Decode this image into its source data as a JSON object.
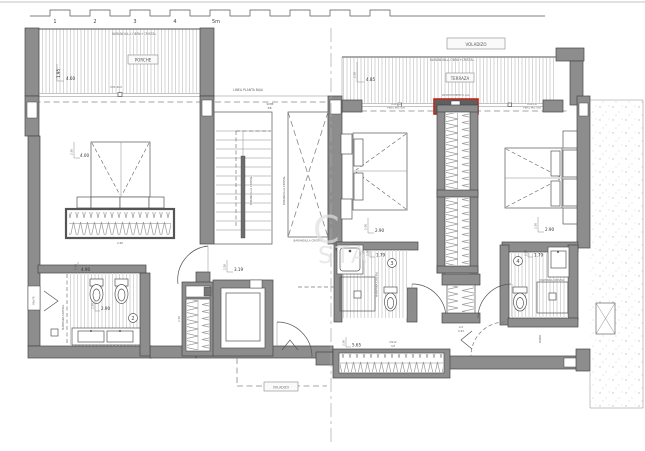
{
  "scale_bar": {
    "labels": [
      "1",
      "2",
      "3",
      "4",
      "5m"
    ]
  },
  "watermark": {
    "line1": "C",
    "line2": "STA"
  },
  "porch": {
    "railing": "BARANDILLA OBRA+CRISTAL",
    "name": "PORCHE",
    "depth": "1.95",
    "width": "4.60",
    "opening": "295x400"
  },
  "facade": {
    "note": "LINEA PLANTA BAJA"
  },
  "terrace": {
    "overhang": "VOLADIZO",
    "railing": "BARANDILLA OBRA+CRISTAL",
    "name": "TERRAZA",
    "height": "2.50",
    "width": "4.85",
    "cladding": "REVESTIMIENTO ALU",
    "blind1": "HUECO",
    "blind2": "PERS.MOTOR"
  },
  "stairs": {
    "up1": "SUBE",
    "up2": "P.B.",
    "rail_a": "BARANDILLA CRISTAL",
    "rail_b": "BARANDILLA CRISTAL",
    "rail_void": "BARANDILLA CRISTAL"
  },
  "master_bedroom": {
    "height": "2.50",
    "width": "4.00",
    "wardrobe": "2.60"
  },
  "bedroom2": {
    "height": "2.50",
    "width": "2.90"
  },
  "bedroom3": {
    "height": "2.50",
    "width": "2.90"
  },
  "bath2": {
    "num": "2",
    "width_top": "4.90",
    "height": "2.50",
    "width": "2.90",
    "window": "90x70",
    "screen": "MAMPARA CRISTAL"
  },
  "bath3": {
    "num": "3",
    "height": "2.50",
    "width": "1.79",
    "screen": "MAMPARA CRISTAL"
  },
  "bath4": {
    "num": "4",
    "height": "2.50",
    "width": "1.79",
    "screen": "MAMPARA CRISTAL",
    "door": "BAÑO"
  },
  "hall": {
    "height": "2.50",
    "width": "3.19",
    "wardrobe": "2.20"
  },
  "closet": {
    "code": "A-5",
    "width": "0.93"
  },
  "wardrobe_long": {
    "height": "2.50",
    "width": "5.65",
    "code": "OS12",
    "type": "3-P"
  },
  "voladizo": {
    "label": "VOLADIZO"
  }
}
